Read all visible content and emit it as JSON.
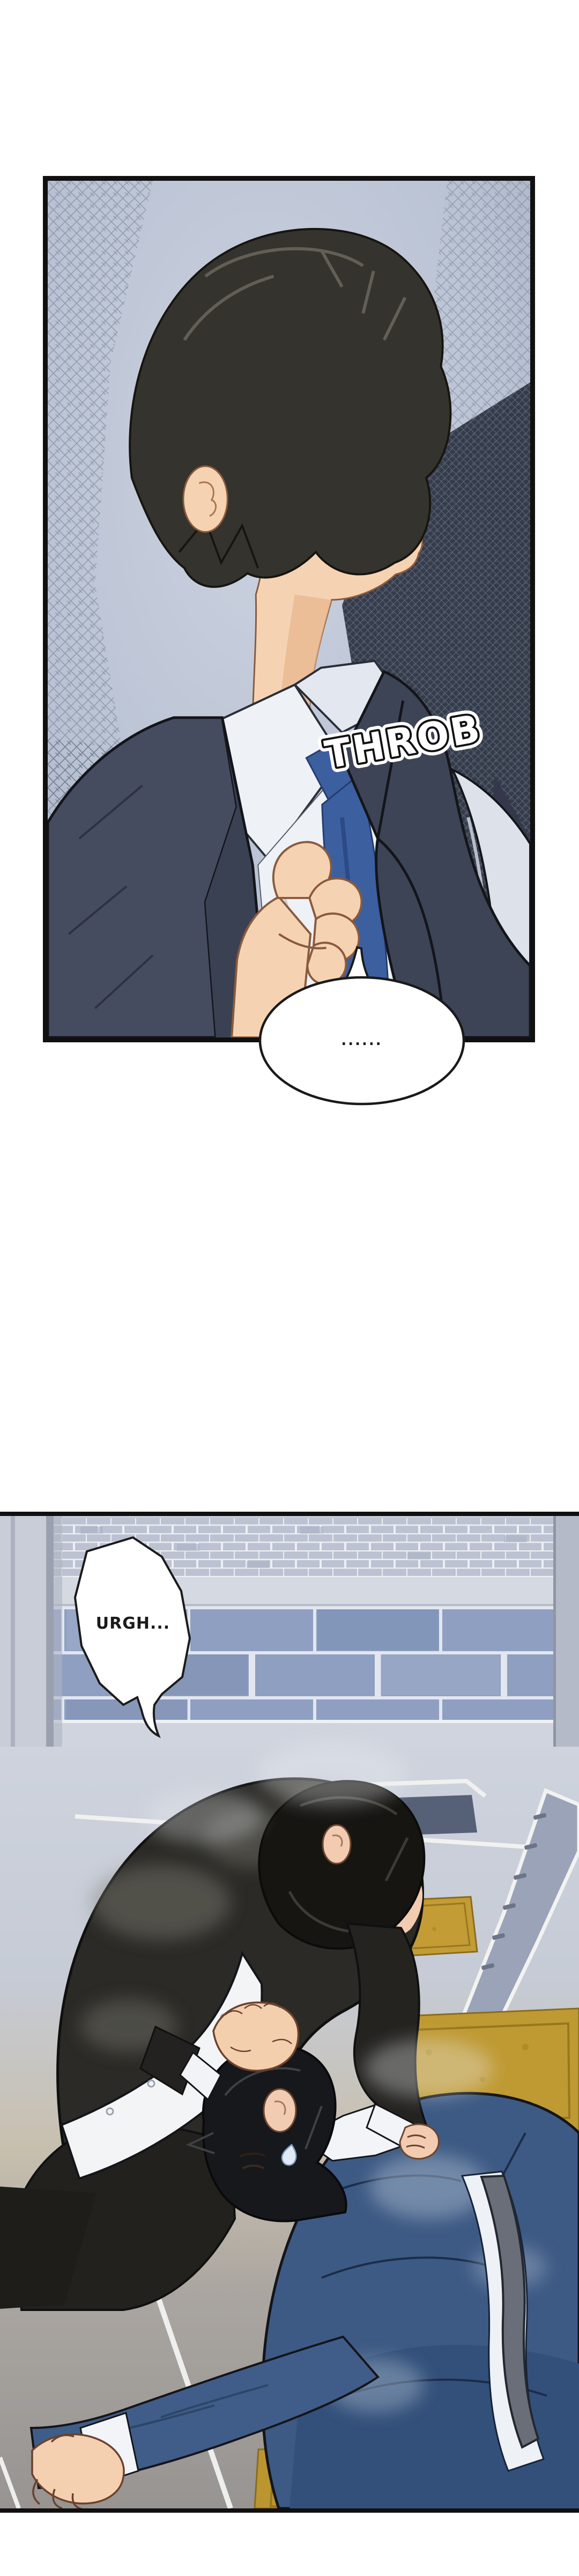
{
  "meta": {
    "type": "webtoon-comic-strip",
    "panel_count": 2
  },
  "panel1": {
    "sfx": "THROB",
    "speech": "......",
    "scene": "Dark-haired man in a dark suit, white shirt and blue tie, seen in three-quarter profile facing right, clutching the front of his shirt over his chest against a cross-hatched blue-gray background",
    "colors": {
      "background": "#b6bfd0",
      "hatch": "#5d6879",
      "dark_wedge": "#2f3645",
      "suit": "#454c60",
      "tie": "#3c5fa0",
      "shirt": "#eef1f6",
      "skin": "#f5d3b2",
      "hair": "#34332e",
      "eye_iris": "#c79a2e",
      "sfx_fill": "#ffffff",
      "sfx_outline": "#111111"
    }
  },
  "panel2": {
    "speech": "URGH...",
    "scene": "Man in a dusty black suit bent over, fist clenched, grabbing a fallen man in a blue suit by the collar; blue brick wall and plaza floor with gold mats in the background",
    "colors": {
      "brick_large": "#8e9fc1",
      "brick_small": "#bcc2d1",
      "mortar": "#e3e7f0",
      "pillar": "#c9cdd7",
      "floor_light": "#ced3dd",
      "floor_warm": "#c8c0af",
      "floor_dark": "#979492",
      "mat_gold": "#bf9932",
      "stripe_dark": "#9aa3b7",
      "suit_black": "#2b2a26",
      "suit_blue": "#3d5a84",
      "shirt": "#f2f4f7",
      "tie_gray": "#6a6e78",
      "skin": "#f3d0b5"
    }
  }
}
